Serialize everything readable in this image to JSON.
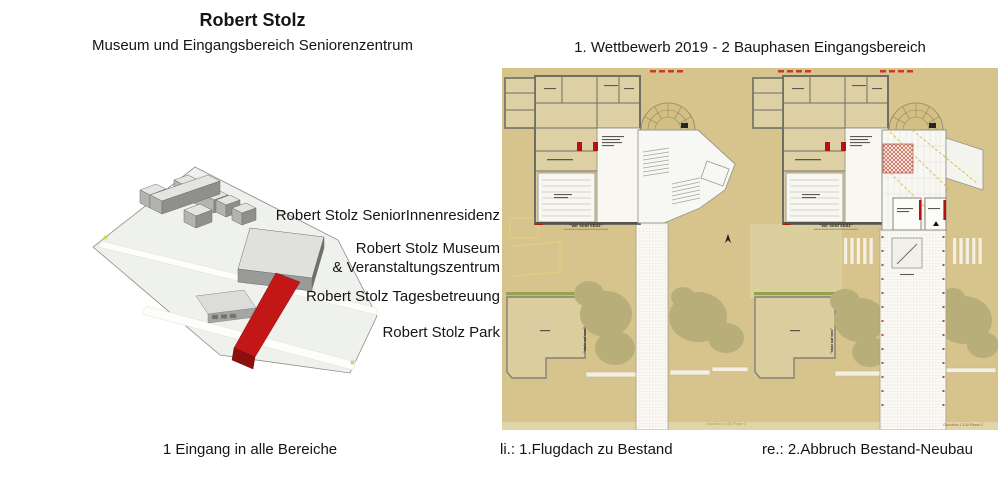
{
  "slide": {
    "title": "Robert Stolz",
    "subtitle": "Museum und Eingangsbereich Seniorenzentrum",
    "competition_title": "1. Wettbewerb 2019 - 2 Bauphasen Eingangsbereich"
  },
  "model": {
    "labels": {
      "residence": "Robert Stolz SeniorInnenresidenz",
      "museum_line1": "Robert Stolz Museum",
      "museum_line2": "& Veranstaltungszentrum",
      "daycare": "Robert Stolz Tagesbetreuung",
      "park": "Robert Stolz Park"
    },
    "caption": "1 Eingang in alle Bereiche"
  },
  "plans": {
    "left": {
      "caption": "li.: 1.Flugdach zu Bestand",
      "motto": "\"wir sind stolz\"",
      "park_label": "\"stolz auf wos\"",
      "scale_note": "Grundriss 1:100 Phase 1"
    },
    "right": {
      "caption": "re.: 2.Abbruch Bestand-Neubau",
      "motto": "\"wir sind stolz\"",
      "park_label": "\"stolz auf wos\"",
      "scale_note": "Grundriss 1:100 Phase 2"
    }
  },
  "colors": {
    "plan_background": "#d7c48d",
    "room_fill": "#ddd0a4",
    "wall_gray": "#6f6e64",
    "tree_green": "#b7ae7a",
    "hedge_green": "#96a14b",
    "accent_red": "#c01414",
    "model_plane": "#eef1ec",
    "model_building_top": "#e4e4e2",
    "model_building_side": "#9a9a98"
  }
}
